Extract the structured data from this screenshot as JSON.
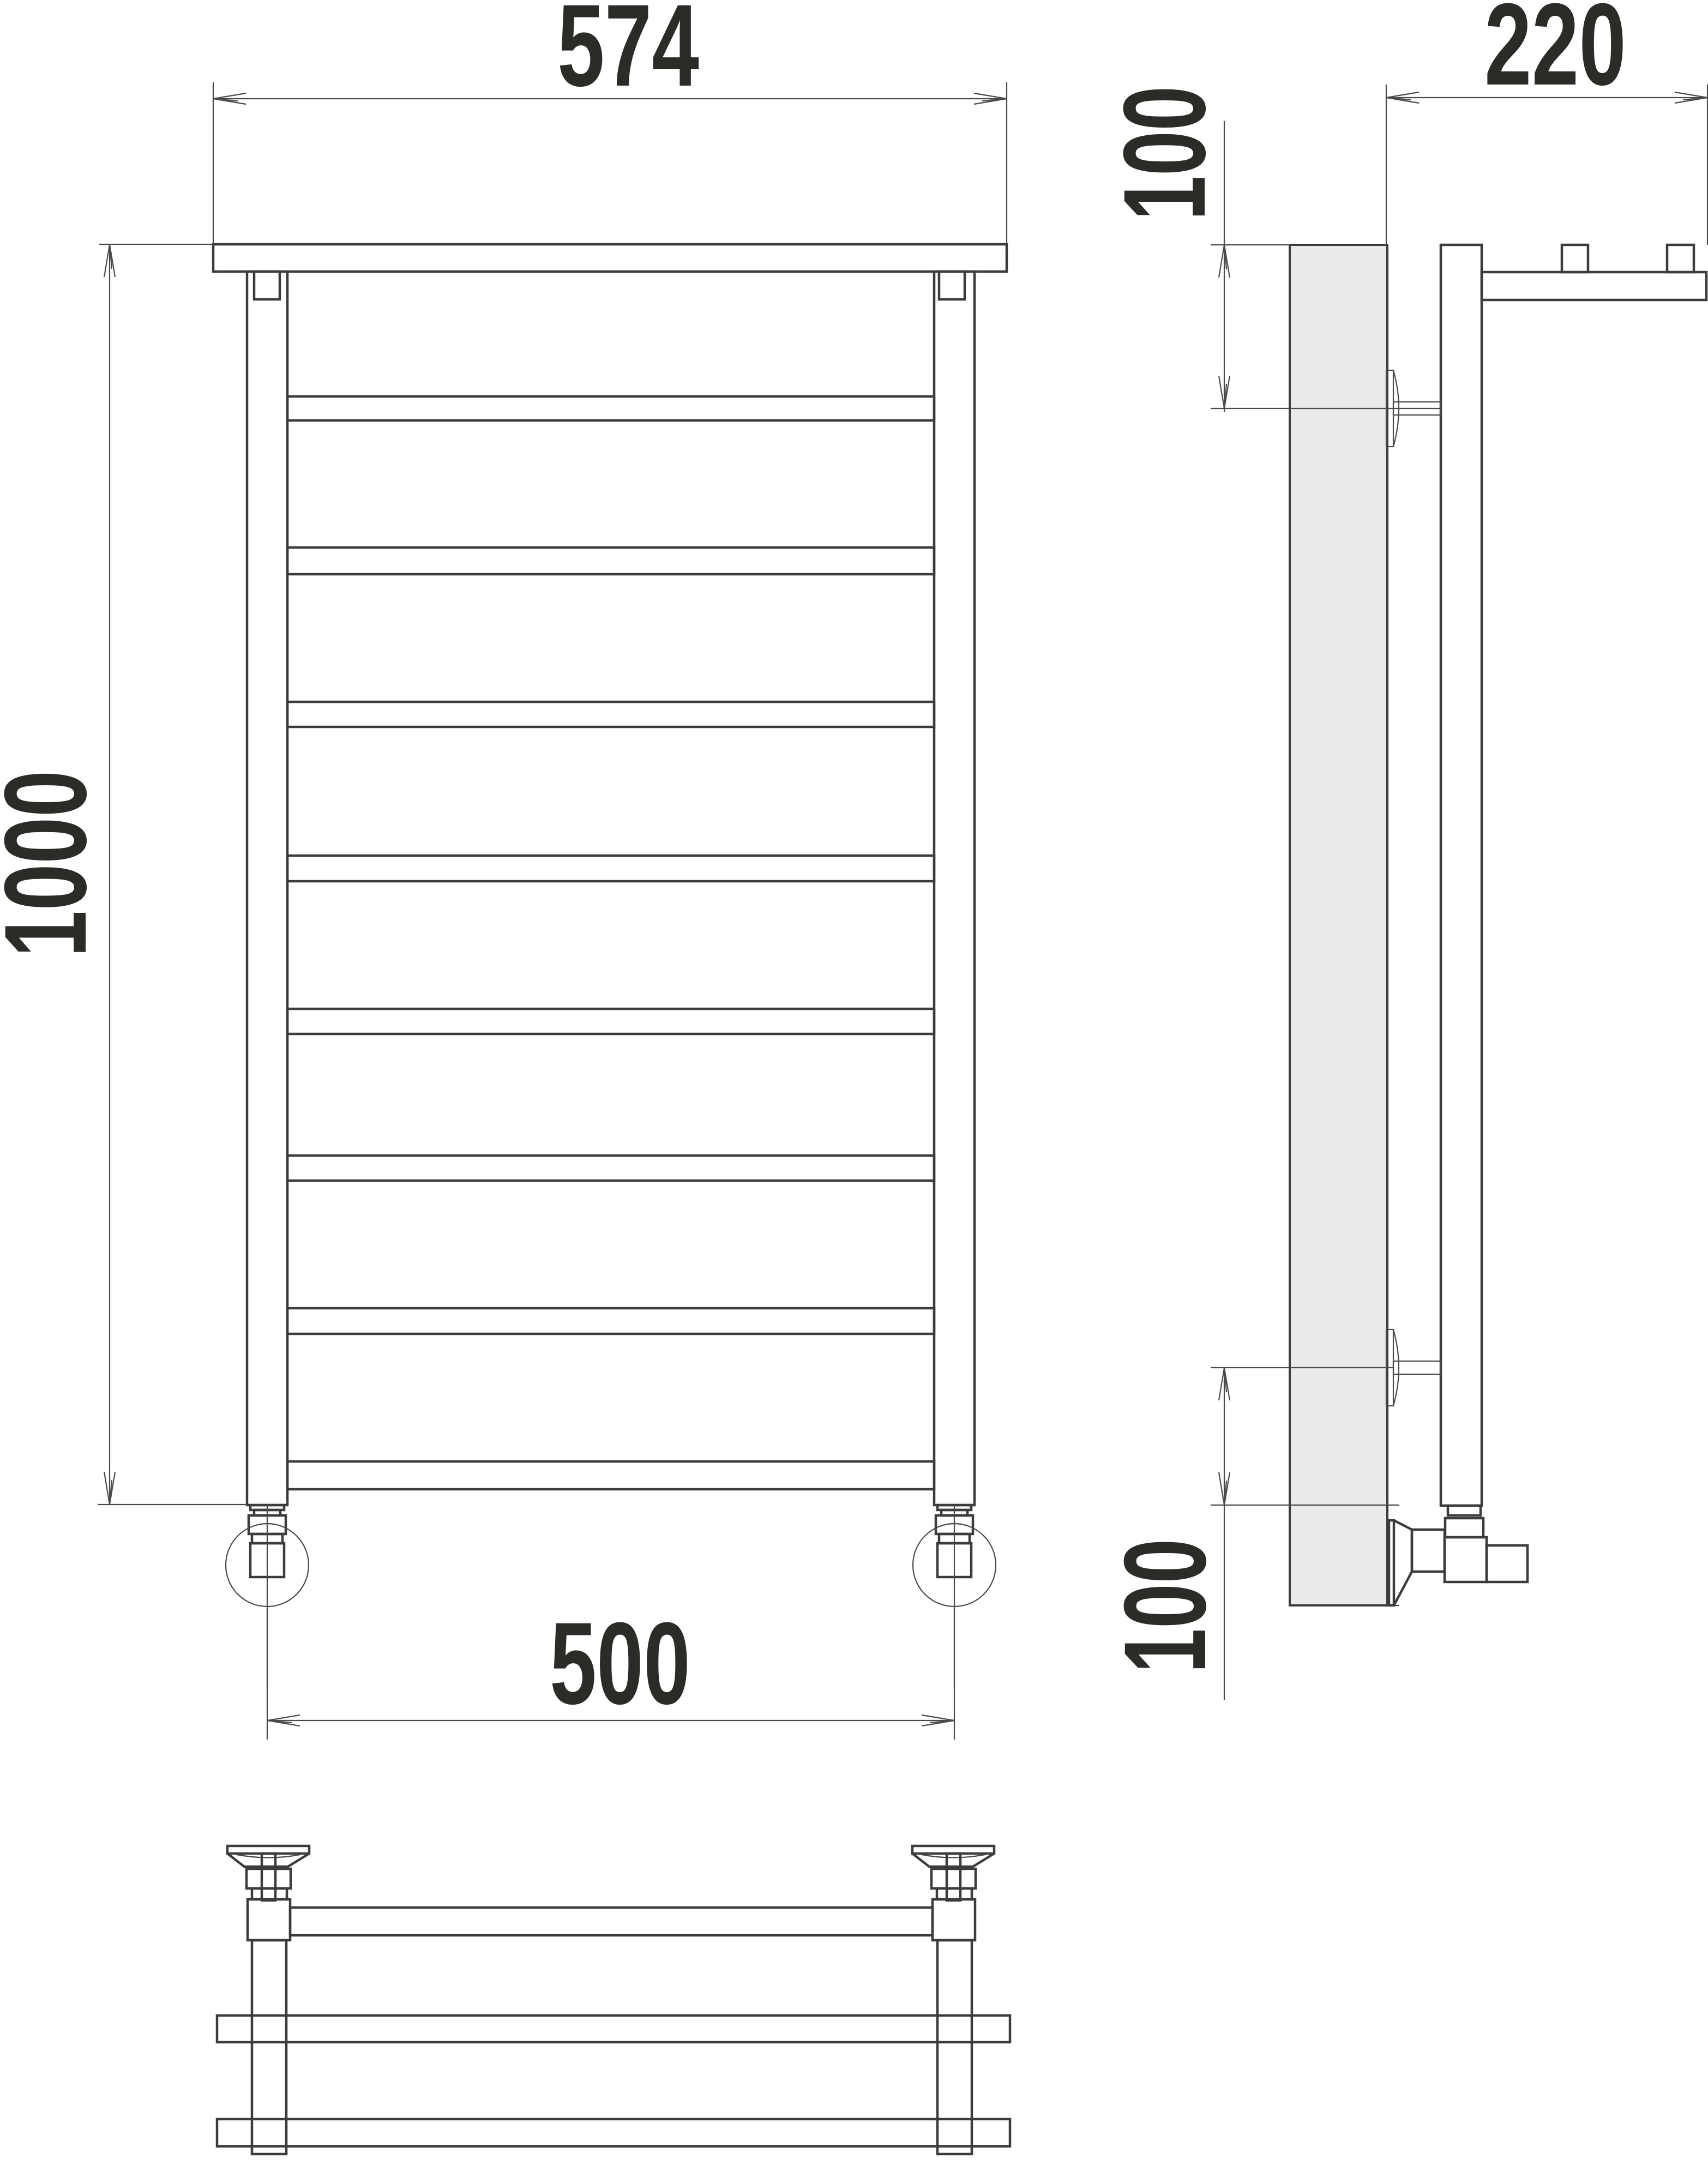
{
  "drawing": {
    "kind": "towel-rail-technical-drawing",
    "colors": {
      "background": "#ffffff",
      "line": "#3c3c3c",
      "thin_line": "#4a4a4a",
      "wall_fill": "#e9eaea",
      "text": "#2b2b28"
    },
    "views": {
      "front": {
        "rungs_visible": 7,
        "has_top_shelf": true,
        "has_bottom_collector": true,
        "feet": 2
      },
      "side": {
        "wall_brackets": 2,
        "shelf_tabs": 2
      },
      "bottom": {
        "valves": 2,
        "shelf_edges": 2
      }
    },
    "dimensions": {
      "overall_width": {
        "label": "574"
      },
      "overall_height": {
        "label": "1000"
      },
      "pipe_spacing": {
        "label": "500"
      },
      "depth": {
        "label": "220"
      },
      "top_offset": {
        "label": "100"
      },
      "bottom_offset": {
        "label": "100"
      }
    }
  }
}
